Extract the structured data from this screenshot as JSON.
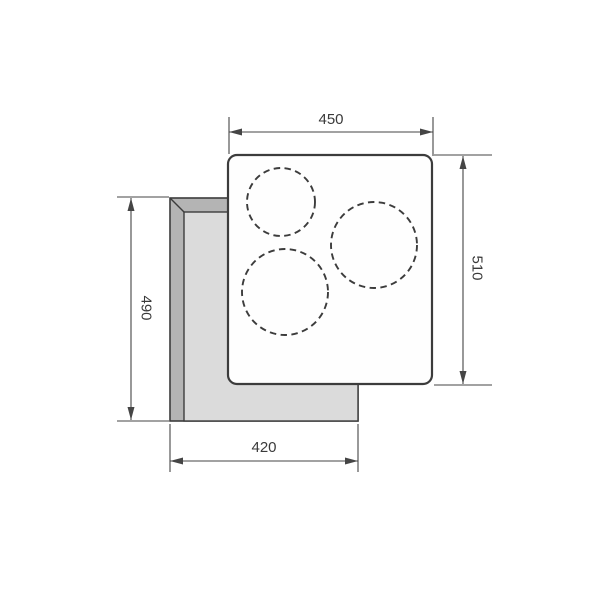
{
  "drawing": {
    "kind": "cooktop-installation-top-view",
    "labels": {
      "top_width": "450",
      "right_height": "510",
      "left_height": "490",
      "bottom_width": "420"
    },
    "zones": [
      {
        "name": "cooking-zone-small-top-left"
      },
      {
        "name": "cooking-zone-large-right"
      },
      {
        "name": "cooking-zone-large-bottom-left"
      }
    ]
  },
  "colors": {
    "page_bg": "#ffffff",
    "line_color": "#3c3c3c",
    "dim_color": "#454545",
    "label_color": "#3a3a3a",
    "cutout_band": "#b4b4b4",
    "cutout_inner": "#dbdbdb",
    "panel_fill": "#fefefe"
  }
}
